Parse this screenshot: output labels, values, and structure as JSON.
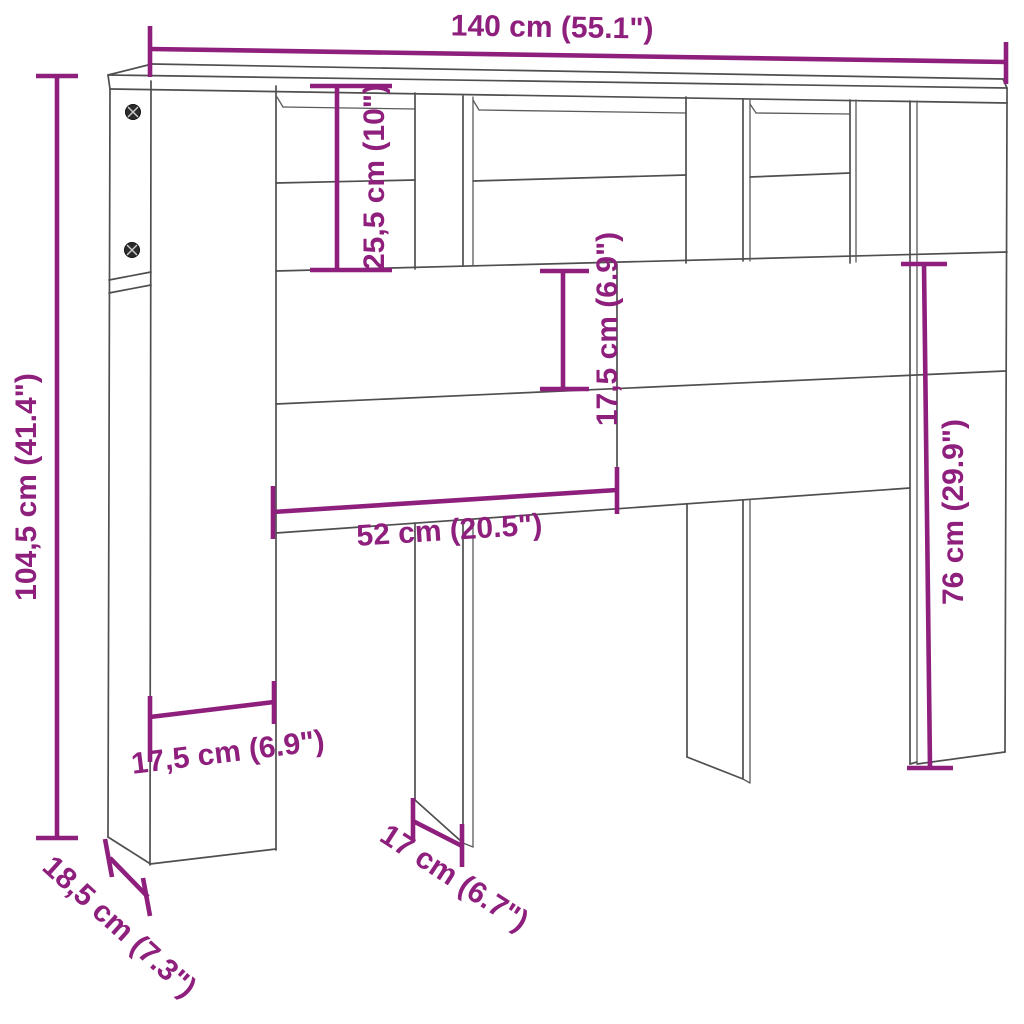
{
  "diagram": {
    "type": "furniture-dimension-line-drawing",
    "subject": "headboard cabinet with open shelf compartments, two middle legs and side panels",
    "background_color": "#ffffff",
    "outline_color": "#4f4f4f",
    "dimension_color": "#8e1f7d"
  },
  "dimensions": {
    "total_width": "140 cm (55.1\")",
    "total_height": "104,5 cm (41.4\")",
    "top_shelf_height": "25,5 cm (10\")",
    "middle_panel_height": "17,5 cm (6.9\")",
    "opening_width": "52 cm (20.5\")",
    "right_section_height": "76 cm (29.9\")",
    "pillar_width": "17,5 cm (6.9\")",
    "side_depth": "18,5 cm (7.3\")",
    "leg_depth": "17 cm (6.7\")"
  }
}
